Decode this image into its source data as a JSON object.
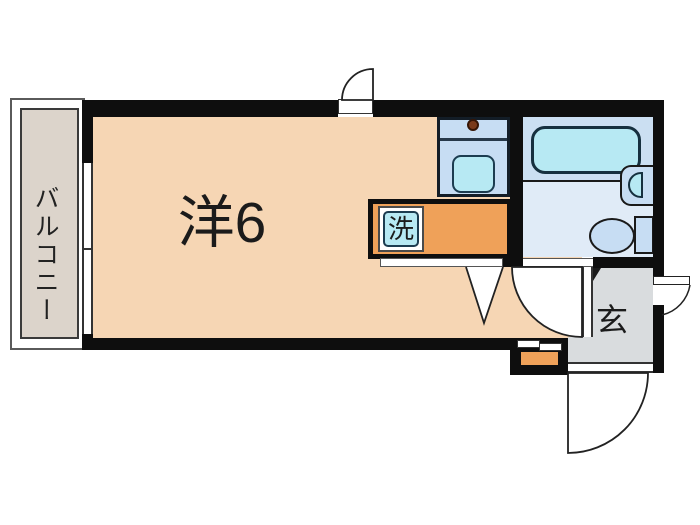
{
  "floorplan": {
    "type": "apartment-floor-plan",
    "rooms": {
      "main_room": {
        "label": "洋6"
      },
      "balcony": {
        "label": "バルコニー"
      },
      "washer": {
        "label": "洗"
      },
      "entrance": {
        "label": "玄"
      }
    },
    "fixtures": [
      "bathtub",
      "toilet",
      "washbasin",
      "kitchen-sink",
      "stove-burner",
      "washing-machine-space",
      "shoe-cabinet",
      "sliding-window",
      "sliding-door"
    ],
    "colors": {
      "wall": "#0e0e0e",
      "room_floor": "#f6d6b4",
      "balcony_floor": "#dcd4cb",
      "entrance_floor": "#d9dcde",
      "bathroom_floor": "#e0ebf7",
      "bathtub_zone": "#cbdff2",
      "counter_blue": "#c7ddf3",
      "fixture_cyan": "#b7e9f3",
      "accent_orange": "#efa159",
      "stove_brown": "#7a3a1a"
    }
  }
}
